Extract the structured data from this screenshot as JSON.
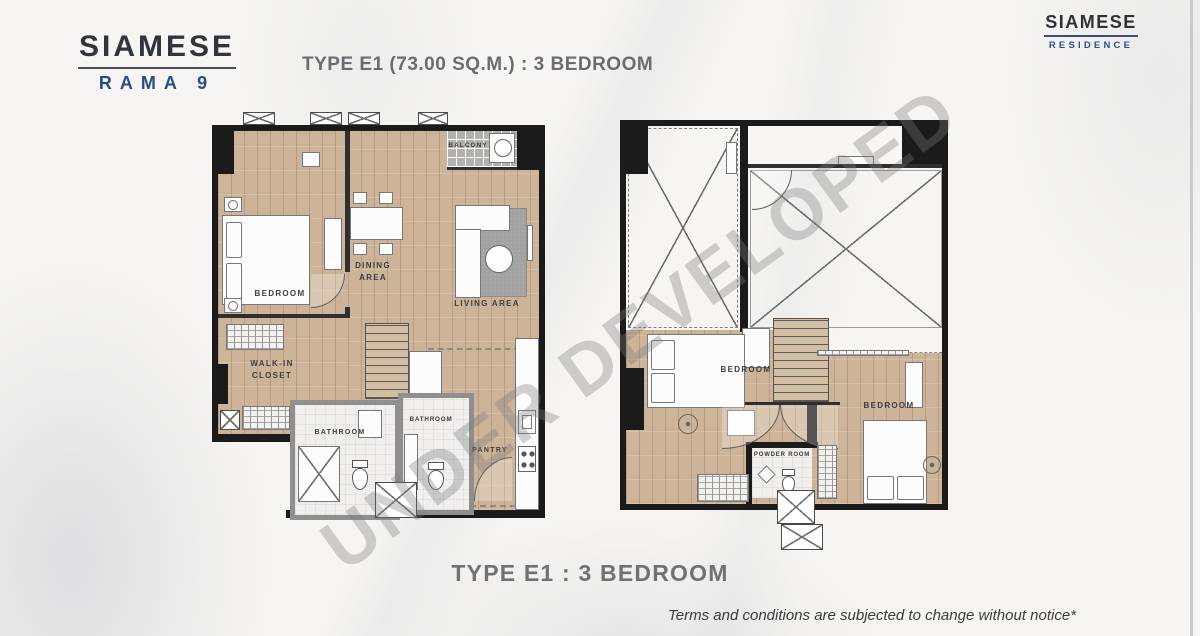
{
  "brand": {
    "logo_left": {
      "name": "SIAMESE",
      "project": "RAMA 9"
    },
    "logo_right": {
      "name": "SIAMESE",
      "division": "RESIDENCE"
    }
  },
  "header": {
    "title": "TYPE E1 (73.00 SQ.M.) : 3 BEDROOM"
  },
  "watermark": {
    "text": "UNDER DEVELOPED"
  },
  "floor1": {
    "rooms": {
      "bedroom": "BEDROOM",
      "dining_area": "DINING AREA",
      "living_area": "LIVING AREA",
      "balcony": "BALCONY",
      "walk_in_closet": "WALK-IN CLOSET",
      "bathroom_a": "BATHROOM",
      "bathroom_b": "BATHROOM",
      "pantry": "PANTRY"
    }
  },
  "floor2": {
    "rooms": {
      "bedroom_a": "BEDROOM",
      "bedroom_b": "BEDROOM",
      "powder_room": "POWDER ROOM"
    }
  },
  "footer": {
    "caption": "TYPE E1 : 3 BEDROOM",
    "disclaimer": "Terms and conditions are subjected to change without notice*"
  },
  "colors": {
    "accent_blue": "#2b4a8c",
    "wall_black": "#1b1b1b",
    "wood_floor": "#cdb499",
    "title_gray": "#6a6c6f",
    "watermark_gray": "#7c7c7c"
  }
}
